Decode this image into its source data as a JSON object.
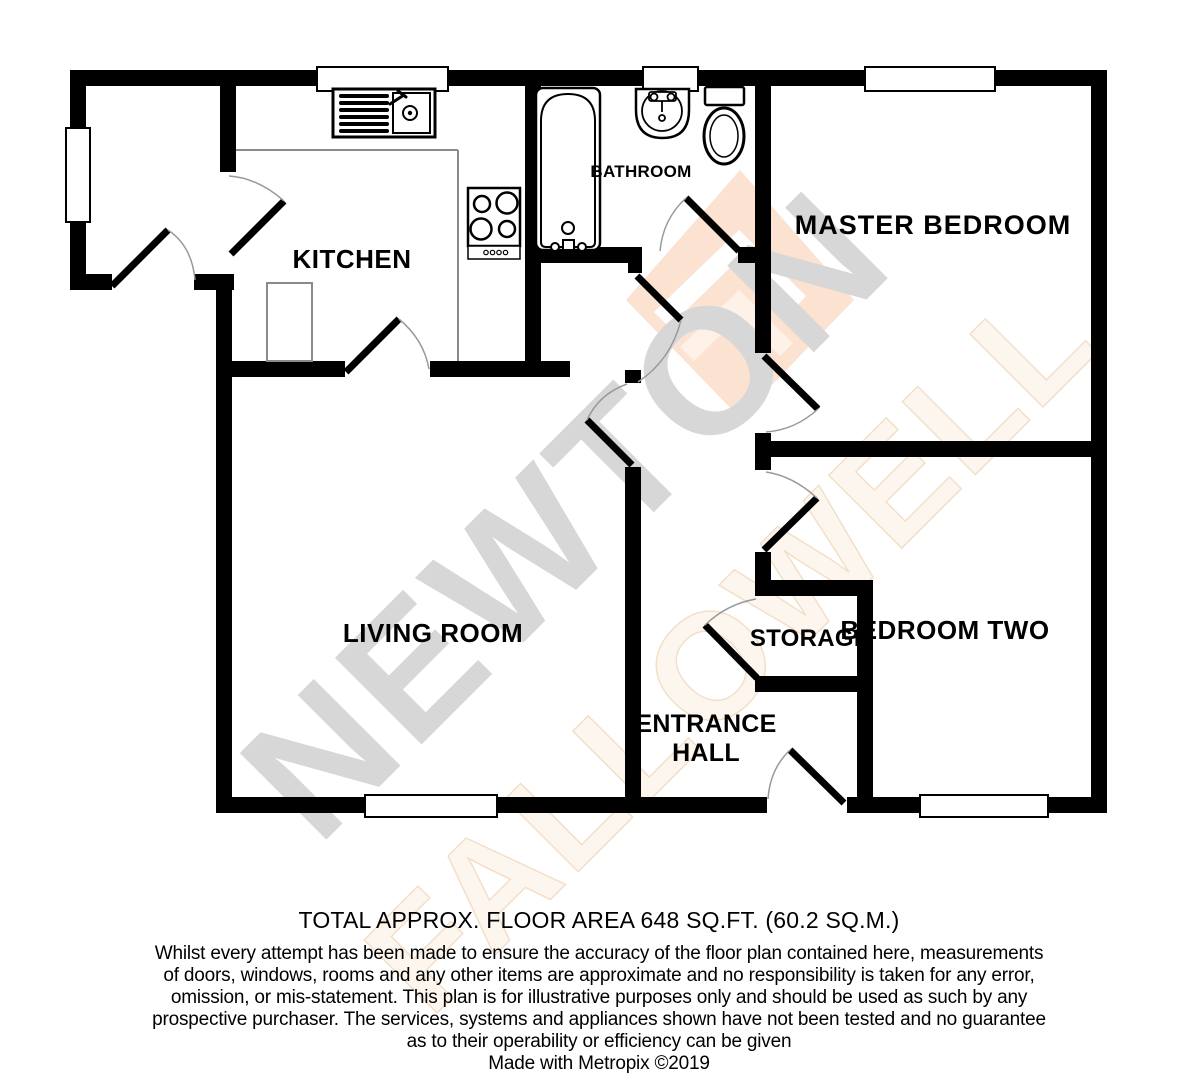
{
  "floorplan": {
    "labels": {
      "kitchen": "KITCHEN",
      "bathroom": "BATHROOM",
      "master_bedroom": "MASTER BEDROOM",
      "living_room": "LIVING ROOM",
      "entrance_hall_line1": "ENTRANCE",
      "entrance_hall_line2": "HALL",
      "storage": "STORAGE",
      "bedroom_two": "BEDROOM TWO"
    },
    "watermark": {
      "line1": "NEWTON",
      "line2": "FALLOWELL"
    },
    "colors": {
      "wall": "#000000",
      "door_arc": "#999999",
      "counter_line": "#8a8a8a",
      "watermark_gray": "#d7d7d7",
      "watermark_peach": "#fbe2d1",
      "watermark_outline": "#f2dcc4"
    }
  },
  "footer": {
    "total_area": "TOTAL APPROX. FLOOR AREA 648 SQ.FT. (60.2 SQ.M.)",
    "disclaimer_lines": [
      "Whilst every attempt has been made to ensure the accuracy of the floor plan contained here, measurements",
      "of doors, windows, rooms and any other items are approximate and no responsibility is taken for any error,",
      "omission, or mis-statement. This plan is for illustrative purposes only and should be used as such by any",
      "prospective purchaser. The services, systems and appliances shown have not been tested and no guarantee",
      "as to their operability or efficiency can be given"
    ],
    "credit": "Made with Metropix ©2019"
  }
}
